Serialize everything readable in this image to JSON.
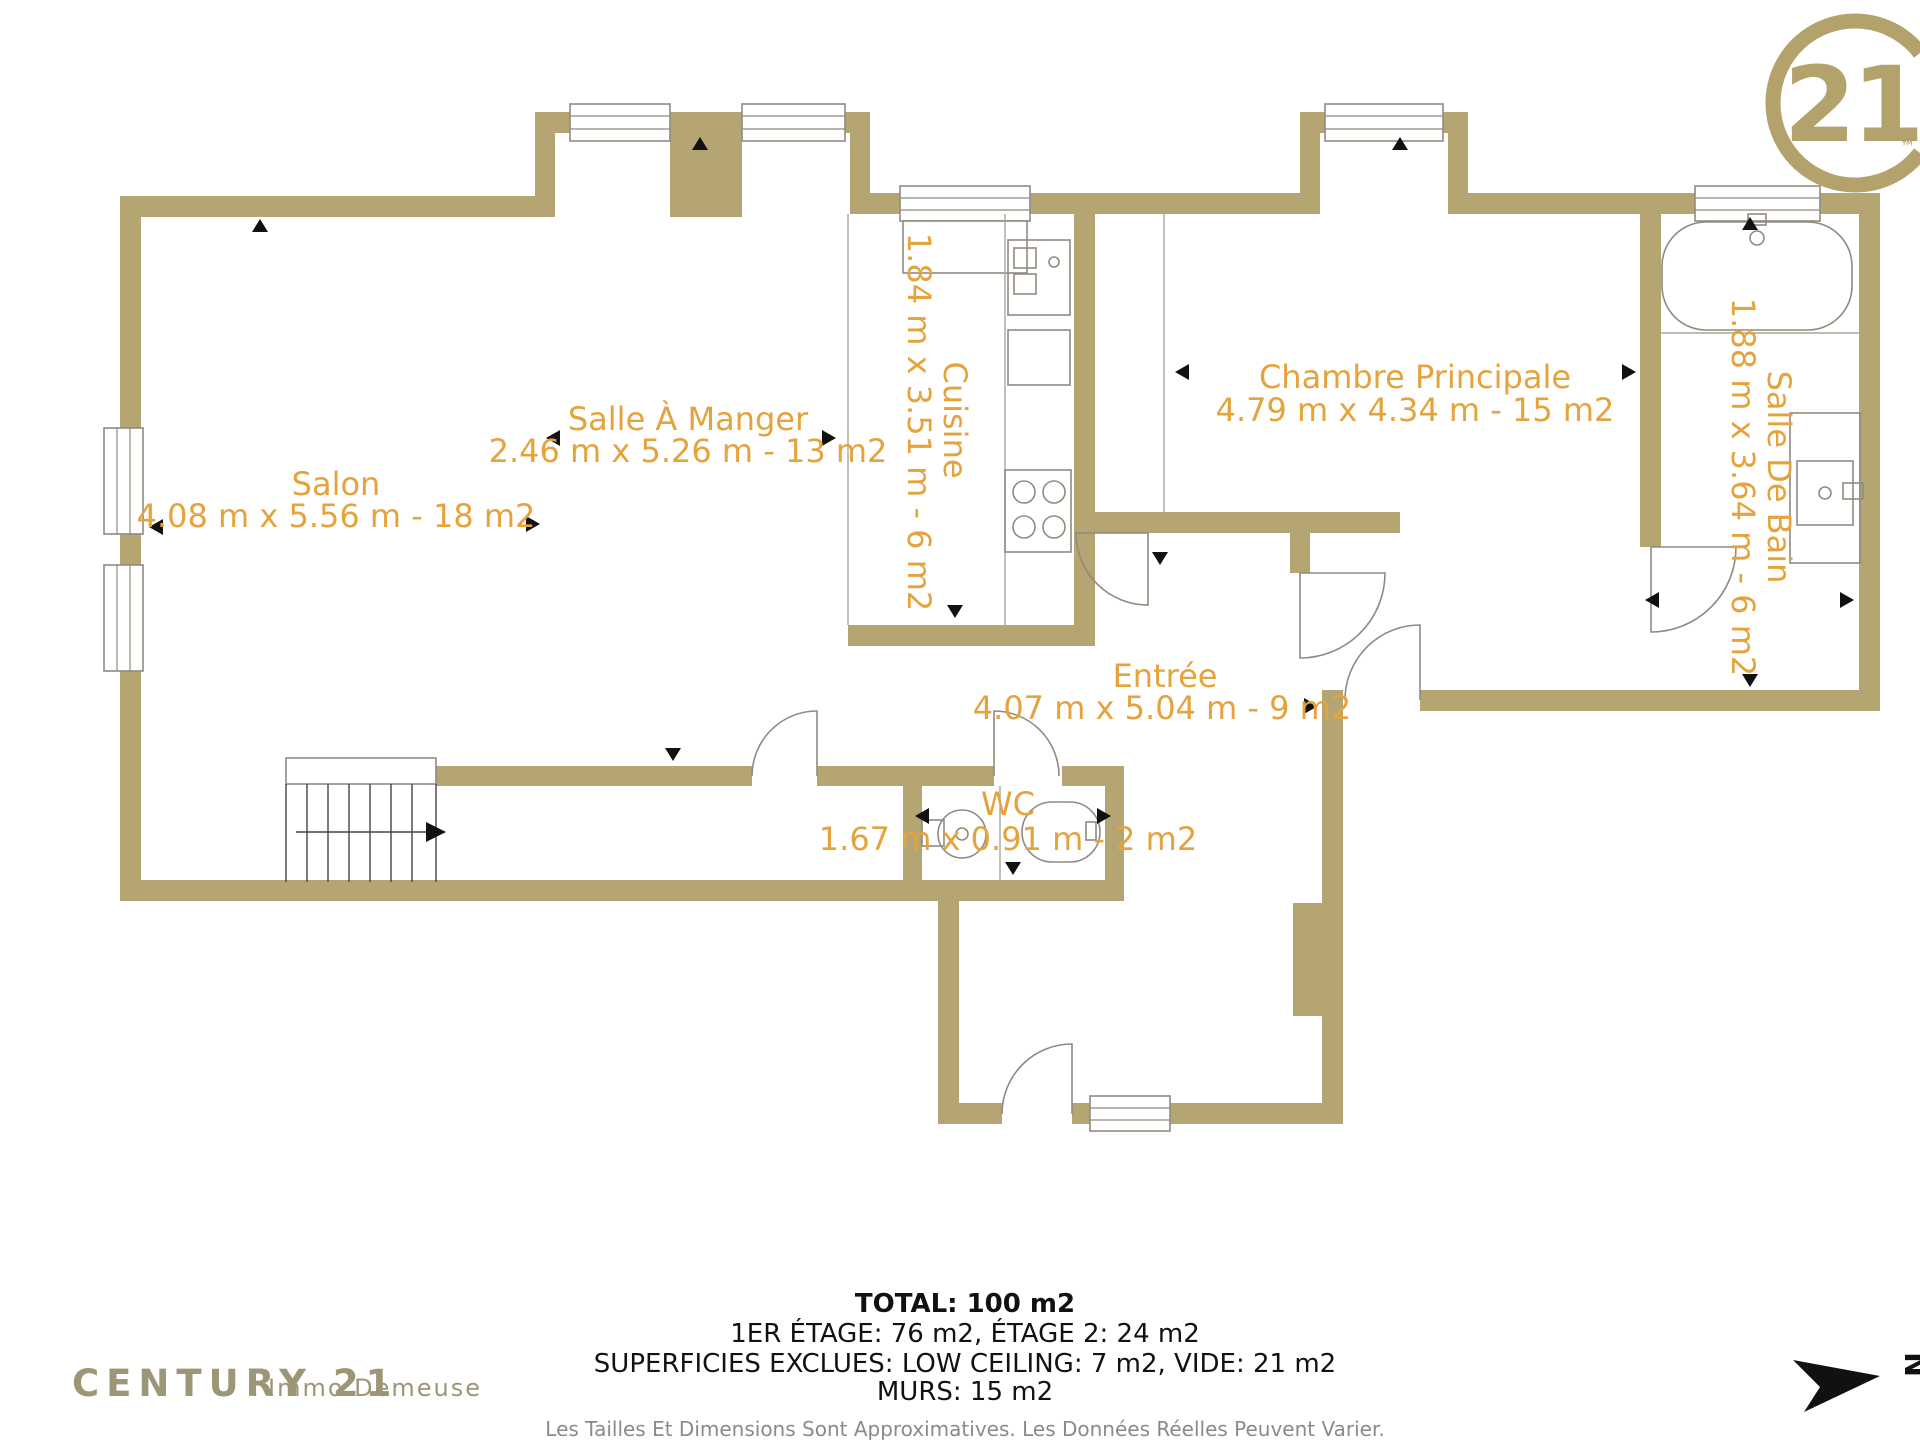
{
  "brand": {
    "logo_number": "21",
    "logo_tm": "™",
    "footer_name": "CENTURY 21",
    "footer_dot": ".",
    "footer_agency": "Immo Demeuse"
  },
  "north": {
    "label": "N"
  },
  "rooms": [
    {
      "id": "salon",
      "name": "Salon",
      "dims": "4.08 m x 5.56 m - 18 m2"
    },
    {
      "id": "salle-a-manger",
      "name": "Salle À Manger",
      "dims": "2.46 m x 5.26 m - 13 m2"
    },
    {
      "id": "cuisine",
      "name": "Cuisine",
      "dims": "1.84 m x 3.51 m - 6 m2"
    },
    {
      "id": "chambre-principale",
      "name": "Chambre Principale",
      "dims": "4.79 m x 4.34 m - 15 m2"
    },
    {
      "id": "salle-de-bain",
      "name": "Salle De Bain",
      "dims": "1.88 m x 3.64 m - 6 m2"
    },
    {
      "id": "entree",
      "name": "Entrée",
      "dims": "4.07 m x 5.04 m - 9 m2"
    },
    {
      "id": "wc",
      "name": "WC",
      "dims": "1.67 m x 0.91 m - 2 m2"
    }
  ],
  "summary": {
    "total": "TOTAL: 100 m2",
    "floors": "1ER ÉTAGE: 76 m2, ÉTAGE 2: 24 m2",
    "excluded": "SUPERFICIES EXCLUES: LOW CEILING: 7 m2, VIDE: 21 m2",
    "walls": "MURS: 15 m2",
    "disclaimer": "Les Tailles Et Dimensions Sont Approximatives. Les Données Réelles Peuvent Varier."
  },
  "colors": {
    "wall": "#b5a573",
    "room_label": "#e5a33c",
    "brand_gold": "#b3a26b",
    "brand_footer": "#9c9576",
    "fixture_outline": "#8f8b80"
  }
}
